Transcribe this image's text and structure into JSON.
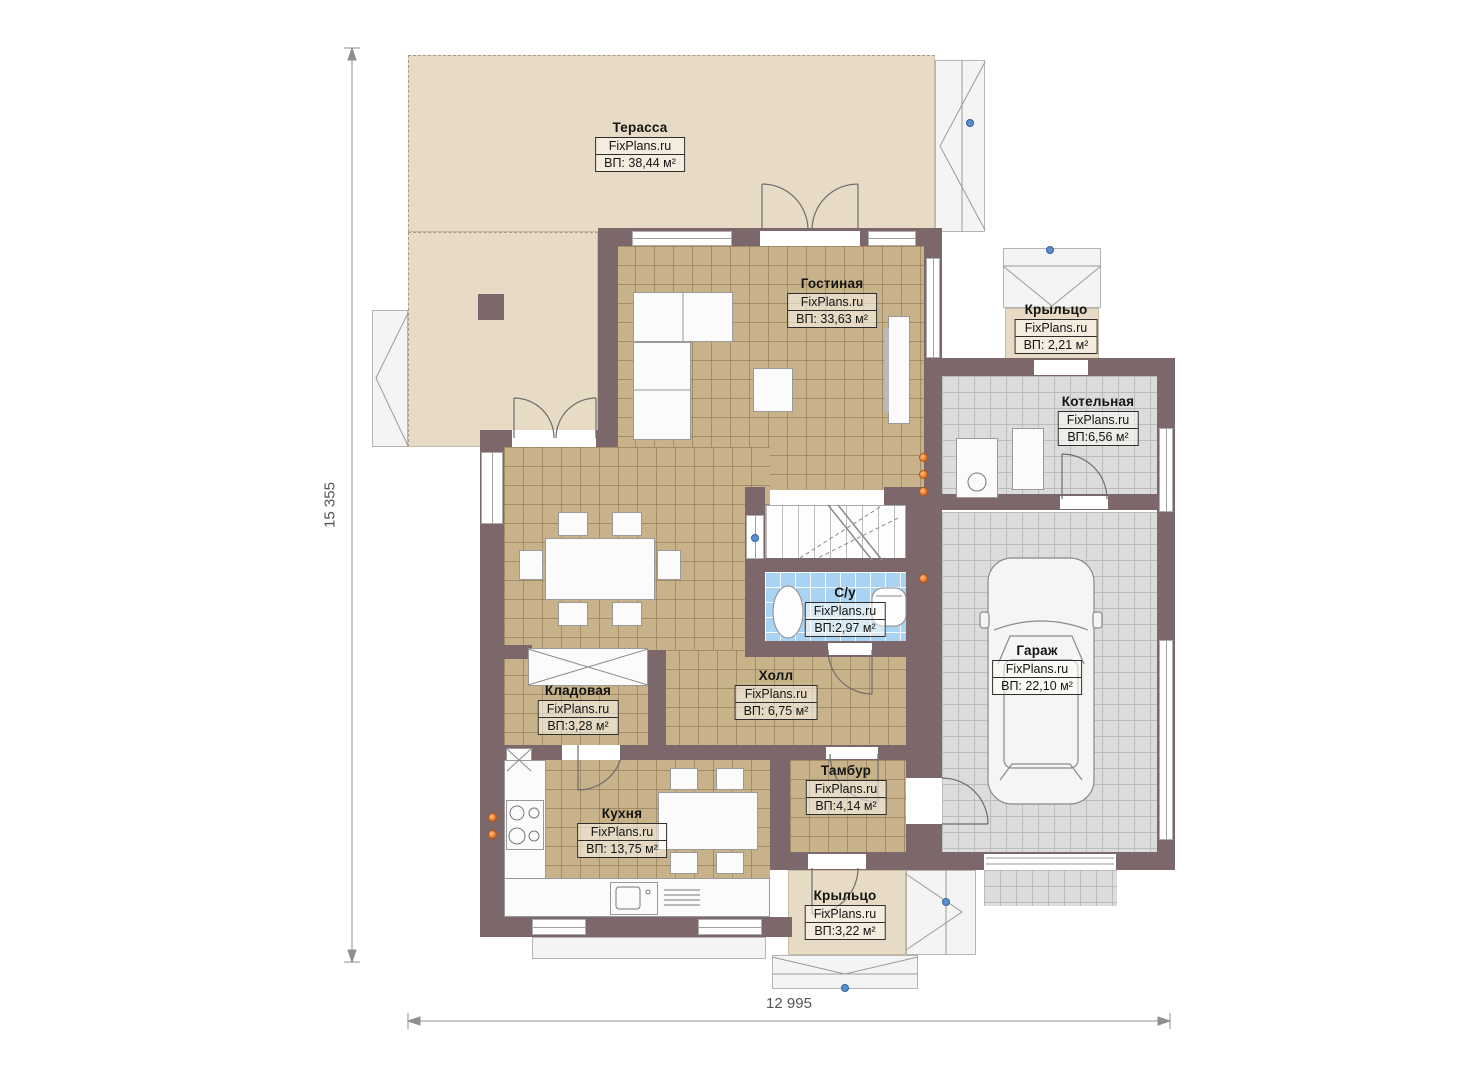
{
  "watermark": "FixPlans.ru",
  "rooms": [
    {
      "name": "Терасса",
      "watermark": "FixPlans.ru",
      "area": "ВП: 38,44 м²"
    },
    {
      "name": "Гостиная",
      "watermark": "FixPlans.ru",
      "area": "ВП: 33,63 м²"
    },
    {
      "name": "Крыльцо",
      "watermark": "FixPlans.ru",
      "area": "ВП: 2,21 м²"
    },
    {
      "name": "Котельная",
      "watermark": "FixPlans.ru",
      "area": "ВП:6,56 м²"
    },
    {
      "name": "С/у",
      "watermark": "FixPlans.ru",
      "area": "ВП:2,97 м²"
    },
    {
      "name": "Гараж",
      "watermark": "FixPlans.ru",
      "area": "ВП: 22,10 м²"
    },
    {
      "name": "Кладовая",
      "watermark": "FixPlans.ru",
      "area": "ВП:3,28 м²"
    },
    {
      "name": "Холл",
      "watermark": "FixPlans.ru",
      "area": "ВП: 6,75 м²"
    },
    {
      "name": "Тамбур",
      "watermark": "FixPlans.ru",
      "area": "ВП:4,14 м²"
    },
    {
      "name": "Кухня",
      "watermark": "FixPlans.ru",
      "area": "ВП: 13,75 м²"
    },
    {
      "name": "Крыльцо",
      "watermark": "FixPlans.ru",
      "area": "ВП:3,22 м²"
    }
  ],
  "dimensions": {
    "height_total": "15 355",
    "width_total": "12 995"
  },
  "colors": {
    "wall": "#7c686a",
    "floor_tile_tan": "#c8b28a",
    "floor_tile_gray": "#dcdcdc",
    "floor_tile_blue": "#a9d3f2",
    "terrace_beige": "#e7dbc6",
    "marker_orange": "#e8762a",
    "marker_blue": "#4a7fc0"
  }
}
